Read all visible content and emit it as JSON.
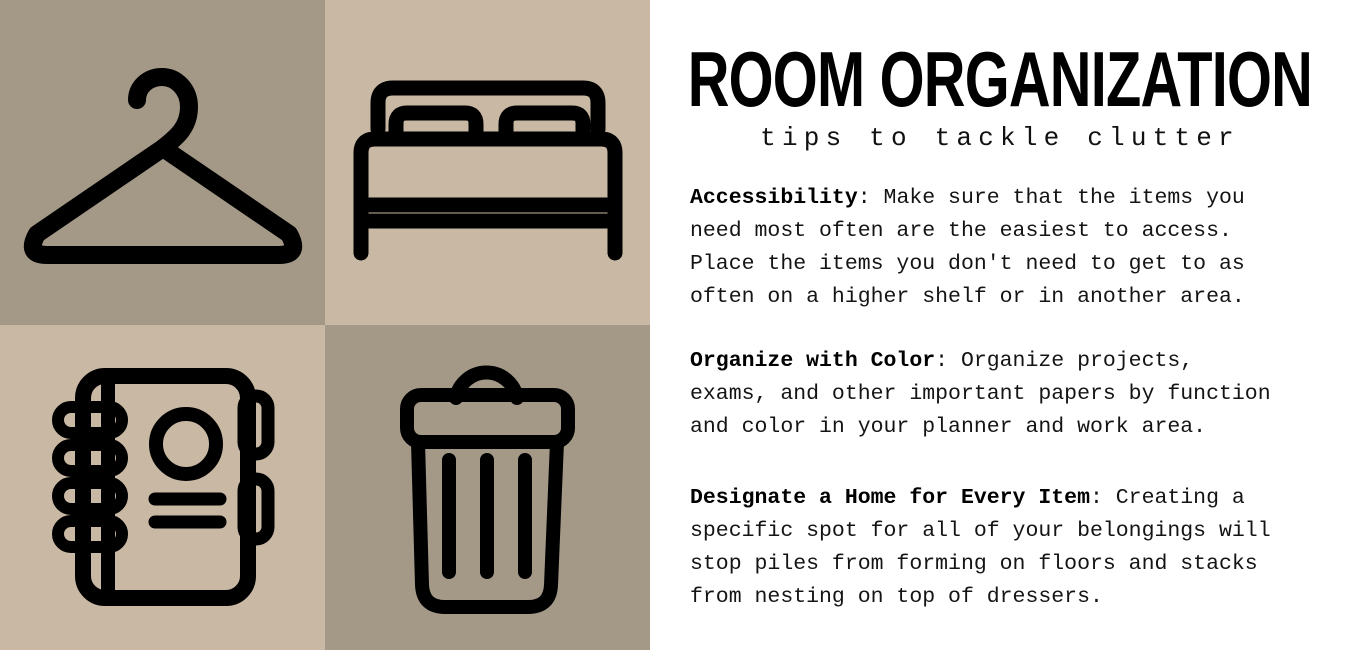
{
  "poster": {
    "title": "ROOM ORGANIZATION",
    "subtitle": "tips to tackle clutter"
  },
  "tips": [
    {
      "heading": "Accessibility",
      "body": ": Make sure that the items you need most often are the easiest to access. Place the items you don't need to get to as often on a higher shelf or in another area."
    },
    {
      "heading": "Organize with Color",
      "body": ": Organize projects, exams, and other important papers by function and color in your planner and work area."
    },
    {
      "heading": "Designate a Home for Every Item",
      "body": ": Creating a specific spot for all of your belongings will stop piles from forming on floors and stacks from nesting on top of dressers."
    }
  ],
  "icons": {
    "top_left": "hanger-icon",
    "top_right": "bed-icon",
    "bottom_left": "notebook-icon",
    "bottom_right": "trash-icon"
  },
  "colors": {
    "dark_taupe": "#a49987",
    "light_tan": "#c8b8a4",
    "panel_background": "#ffffff",
    "ink": "#000000"
  }
}
